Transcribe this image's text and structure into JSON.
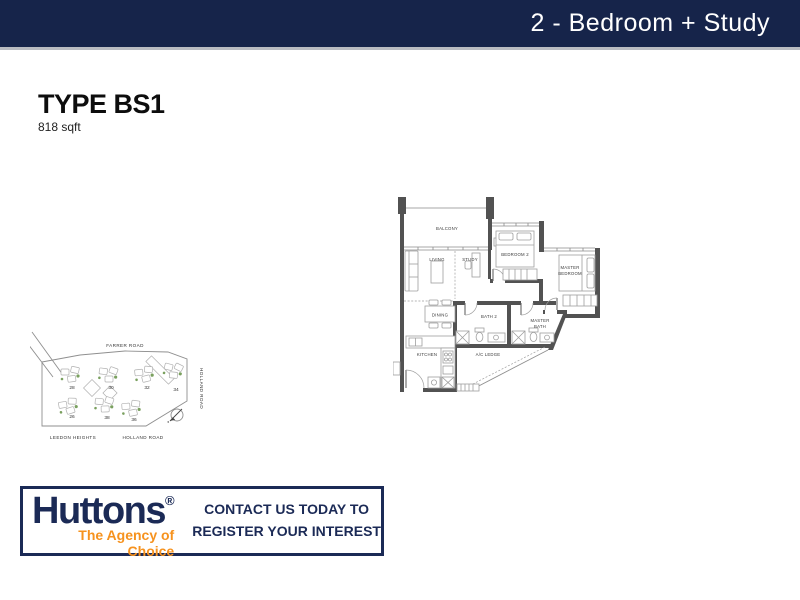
{
  "header": {
    "title": "2 - Bedroom + Study"
  },
  "unit": {
    "type": "TYPE BS1",
    "area": "818 sqft"
  },
  "floorplan": {
    "labels": {
      "balcony": "BALCONY",
      "living": "LIVING",
      "study": "STUDY",
      "bedroom2": "BEDROOM 2",
      "master_bedroom_line1": "MASTER",
      "master_bedroom_line2": "BEDROOM",
      "dining": "DINING",
      "bath2": "BATH 2",
      "master_bath_line1": "MASTER",
      "master_bath_line2": "BATH",
      "ac_ledge": "A/C LEDGE",
      "kitchen": "KITCHEN"
    }
  },
  "sitemap": {
    "farrer_road": "FARRER ROAD",
    "holland_road_side": "HOLLAND ROAD",
    "leedon_heights": "LEEDON HEIGHTS",
    "holland_road_bottom": "HOLLAND ROAD",
    "blocks": [
      "28",
      "30",
      "32",
      "34",
      "26",
      "38",
      "36"
    ]
  },
  "footer": {
    "brand": "Huttons",
    "registered_mark": "®",
    "tagline": "The Agency of Choice",
    "cta_line1": "CONTACT US TODAY TO",
    "cta_line2": "REGISTER YOUR INTEREST"
  },
  "colors": {
    "navy": "#16244a",
    "orange": "#f6921e",
    "wall_gray": "#525252"
  }
}
